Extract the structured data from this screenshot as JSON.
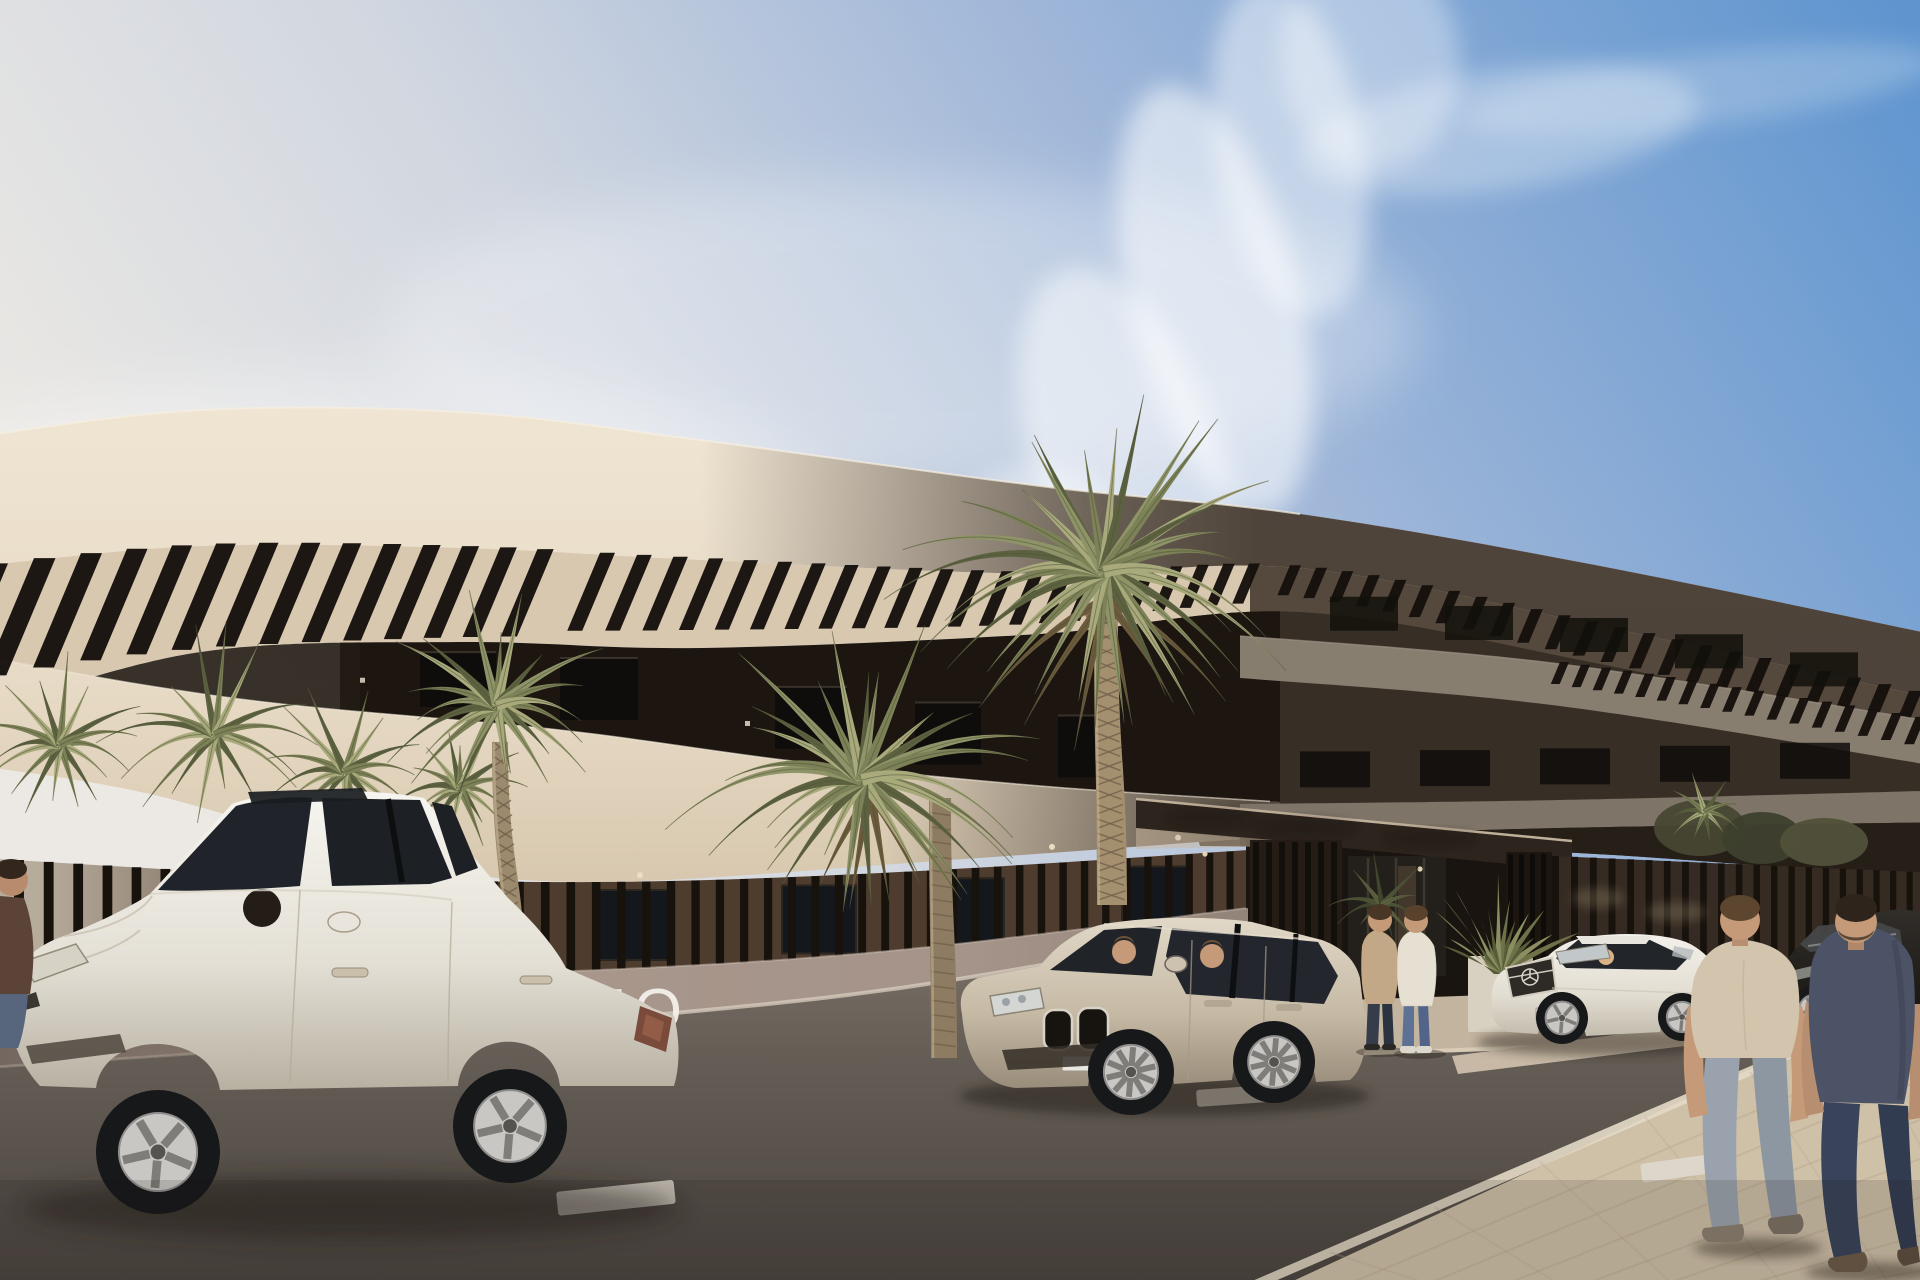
{
  "scene": {
    "type": "architectural-exterior-render",
    "description": "Photorealistic render of a curved modern apartment building with cream balcony bands, pergola slats, street palms, a slatted entrance canopy, parked cars and pedestrians on a sunny day",
    "wall_sign": {
      "text": "TO",
      "color": "#f4f1ea"
    },
    "sky": {
      "left_haze": "#ece9e4",
      "mid": "#cdd5e0",
      "top_right_blue": "#5f95cf",
      "cloud": "#ffffff"
    },
    "colors": {
      "facade_cream": "#e7dac5",
      "facade_cream_deep": "#cbbba2",
      "facade_soffit": "#d8c8b0",
      "facade_dark_floor": "#1c1510",
      "shadow_mass": "#372f26",
      "shadow_band_gray": "#8a8173",
      "pergola_slat": "#15100c",
      "ground_wall": "#4e3d2e",
      "ground_wall_light": "#b7ab9c",
      "window_glass": "#14171b",
      "fence_slat": "#18120d",
      "front_wall": "#a8968b",
      "front_wall_shadow": "#746760",
      "road": "#6e655d",
      "road_dark": "#4b4540",
      "sidewalk": "#cfc0a8",
      "lane_marking": "#ded8cd",
      "palm_dark": "#5c6240",
      "palm_mid": "#7c8157",
      "palm_light": "#a9aa7c",
      "palm_dead": "#6b5a3c",
      "trunk": "#9b8a6e",
      "trunk_shade": "#71604a",
      "car_white": "#efece5",
      "suv_champagne": "#cdc2af",
      "mercedes_white": "#f0ede6",
      "sedan_dark": "#26231f",
      "shirt_tan": "#d2c4ad",
      "shirt_slate": "#4d5366",
      "jeans_light": "#9aa3ad",
      "jeans_dark": "#39445a",
      "skin": "#c49a78",
      "canopy_dark": "#2c241d"
    },
    "vehicles": [
      {
        "name": "white-sedan-foreground",
        "color_word": "white"
      },
      {
        "name": "champagne-suv",
        "color_word": "champagne"
      },
      {
        "name": "white-mercedes",
        "color_word": "white"
      },
      {
        "name": "dark-sedan",
        "color_word": "dark gray"
      }
    ],
    "people": [
      {
        "name": "pedestrian-tan-shirt",
        "where": "sidewalk right, walking away"
      },
      {
        "name": "pedestrian-slate-shirt",
        "where": "sidewalk right, walking away"
      },
      {
        "name": "standing-person-jacket",
        "where": "entrance walkway"
      },
      {
        "name": "standing-person-white-top",
        "where": "entrance walkway"
      },
      {
        "name": "partial-person-left-edge",
        "where": "left edge of frame"
      }
    ]
  }
}
